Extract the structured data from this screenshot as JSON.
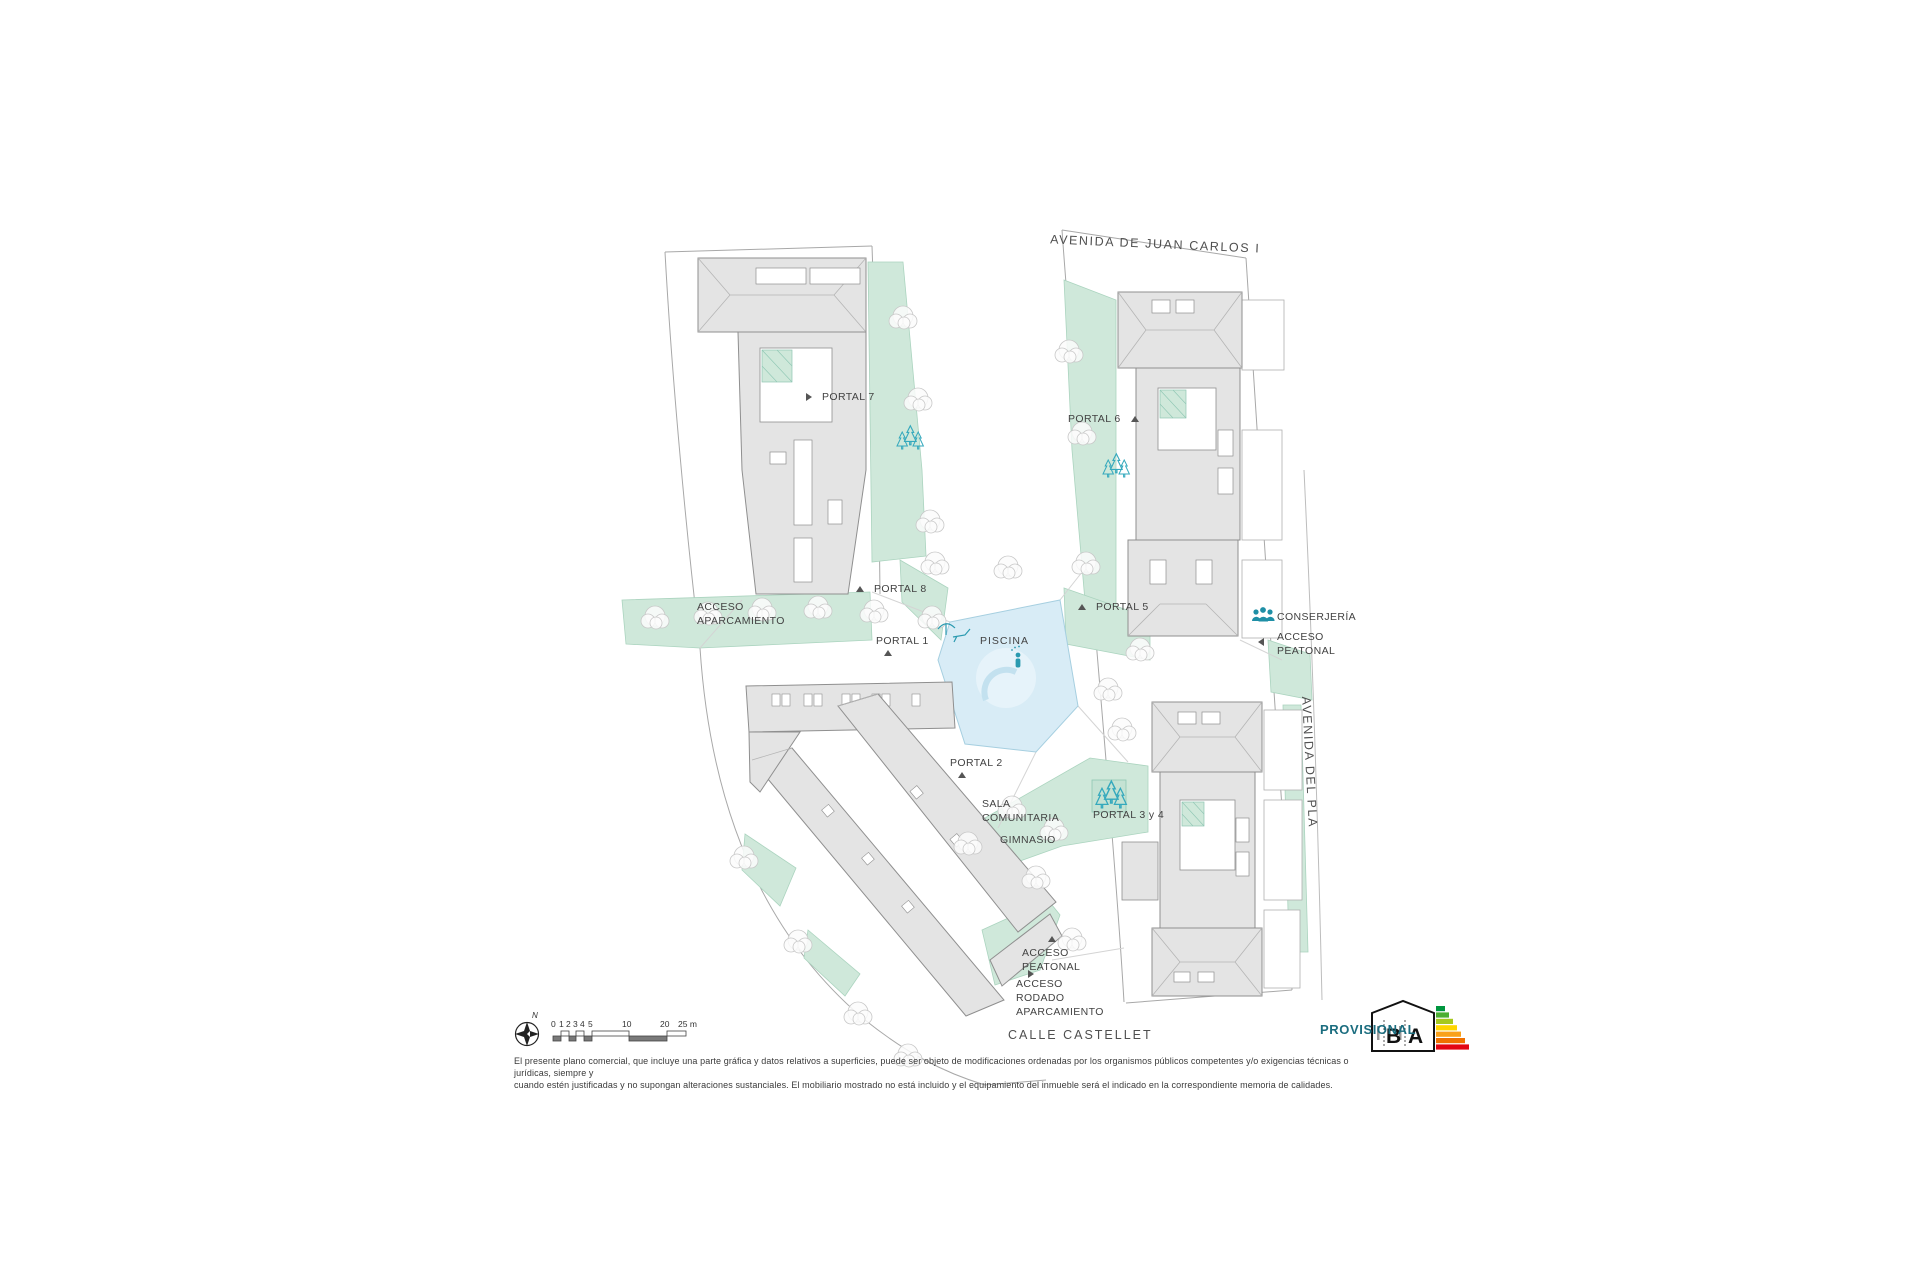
{
  "plan": {
    "streets": {
      "top": "AVENIDA DE JUAN CARLOS I",
      "right": "AVENIDA DEL PLA",
      "bottom": "CALLE CASTELLET"
    },
    "portals": {
      "p1": "PORTAL 1",
      "p2": "PORTAL 2",
      "p34": "PORTAL 3 y 4",
      "p5": "PORTAL 5",
      "p6": "PORTAL 6",
      "p7": "PORTAL 7",
      "p8": "PORTAL 8"
    },
    "areas": {
      "piscina": "PISCINA",
      "sala_comunitaria": "SALA\nCOMUNITARIA",
      "gimnasio": "GIMNASIO",
      "conserjeria": "CONSERJERÍA"
    },
    "accesses": {
      "aparcamiento": "ACCESO\nAPARCAMIENTO",
      "peatonal_right": "ACCESO\nPEATONAL",
      "peatonal_bottom": "ACCESO\nPEATONAL",
      "rodado": "ACCESO\nRODADO\nAPARCAMIENTO"
    }
  },
  "scalebar": {
    "north_letter": "N",
    "ticks": [
      "0",
      "1",
      "2",
      "3",
      "4",
      "5",
      "10",
      "20",
      "25 m"
    ]
  },
  "stamp": {
    "provisional": "PROVISIONAL",
    "energy_letters": [
      "B",
      "A"
    ]
  },
  "footer": {
    "disclaimer": "El presente plano comercial, que incluye una parte gráfica y datos relativos a superficies, puede ser objeto de modificaciones ordenadas por los organismos públicos competentes y/o exigencias técnicas o jurídicas, siempre y\ncuando estén justificadas y no supongan alteraciones sustanciales. El mobiliario mostrado no está incluido y el equipamiento del inmueble será el indicado en la correspondiente memoria de calidades."
  },
  "colors": {
    "building_gray": "#e4e4e4",
    "building_stroke": "#8f8f8f",
    "green_area": "#cfe8da",
    "pool_blue": "#d8ecf6",
    "accent_teal": "#2fa6ba",
    "provisional_text": "#1b6d7f",
    "energy_scale": [
      "#00963f",
      "#4caf32",
      "#a6c91e",
      "#ffd500",
      "#f9a11b",
      "#ef7100",
      "#e30613"
    ]
  }
}
